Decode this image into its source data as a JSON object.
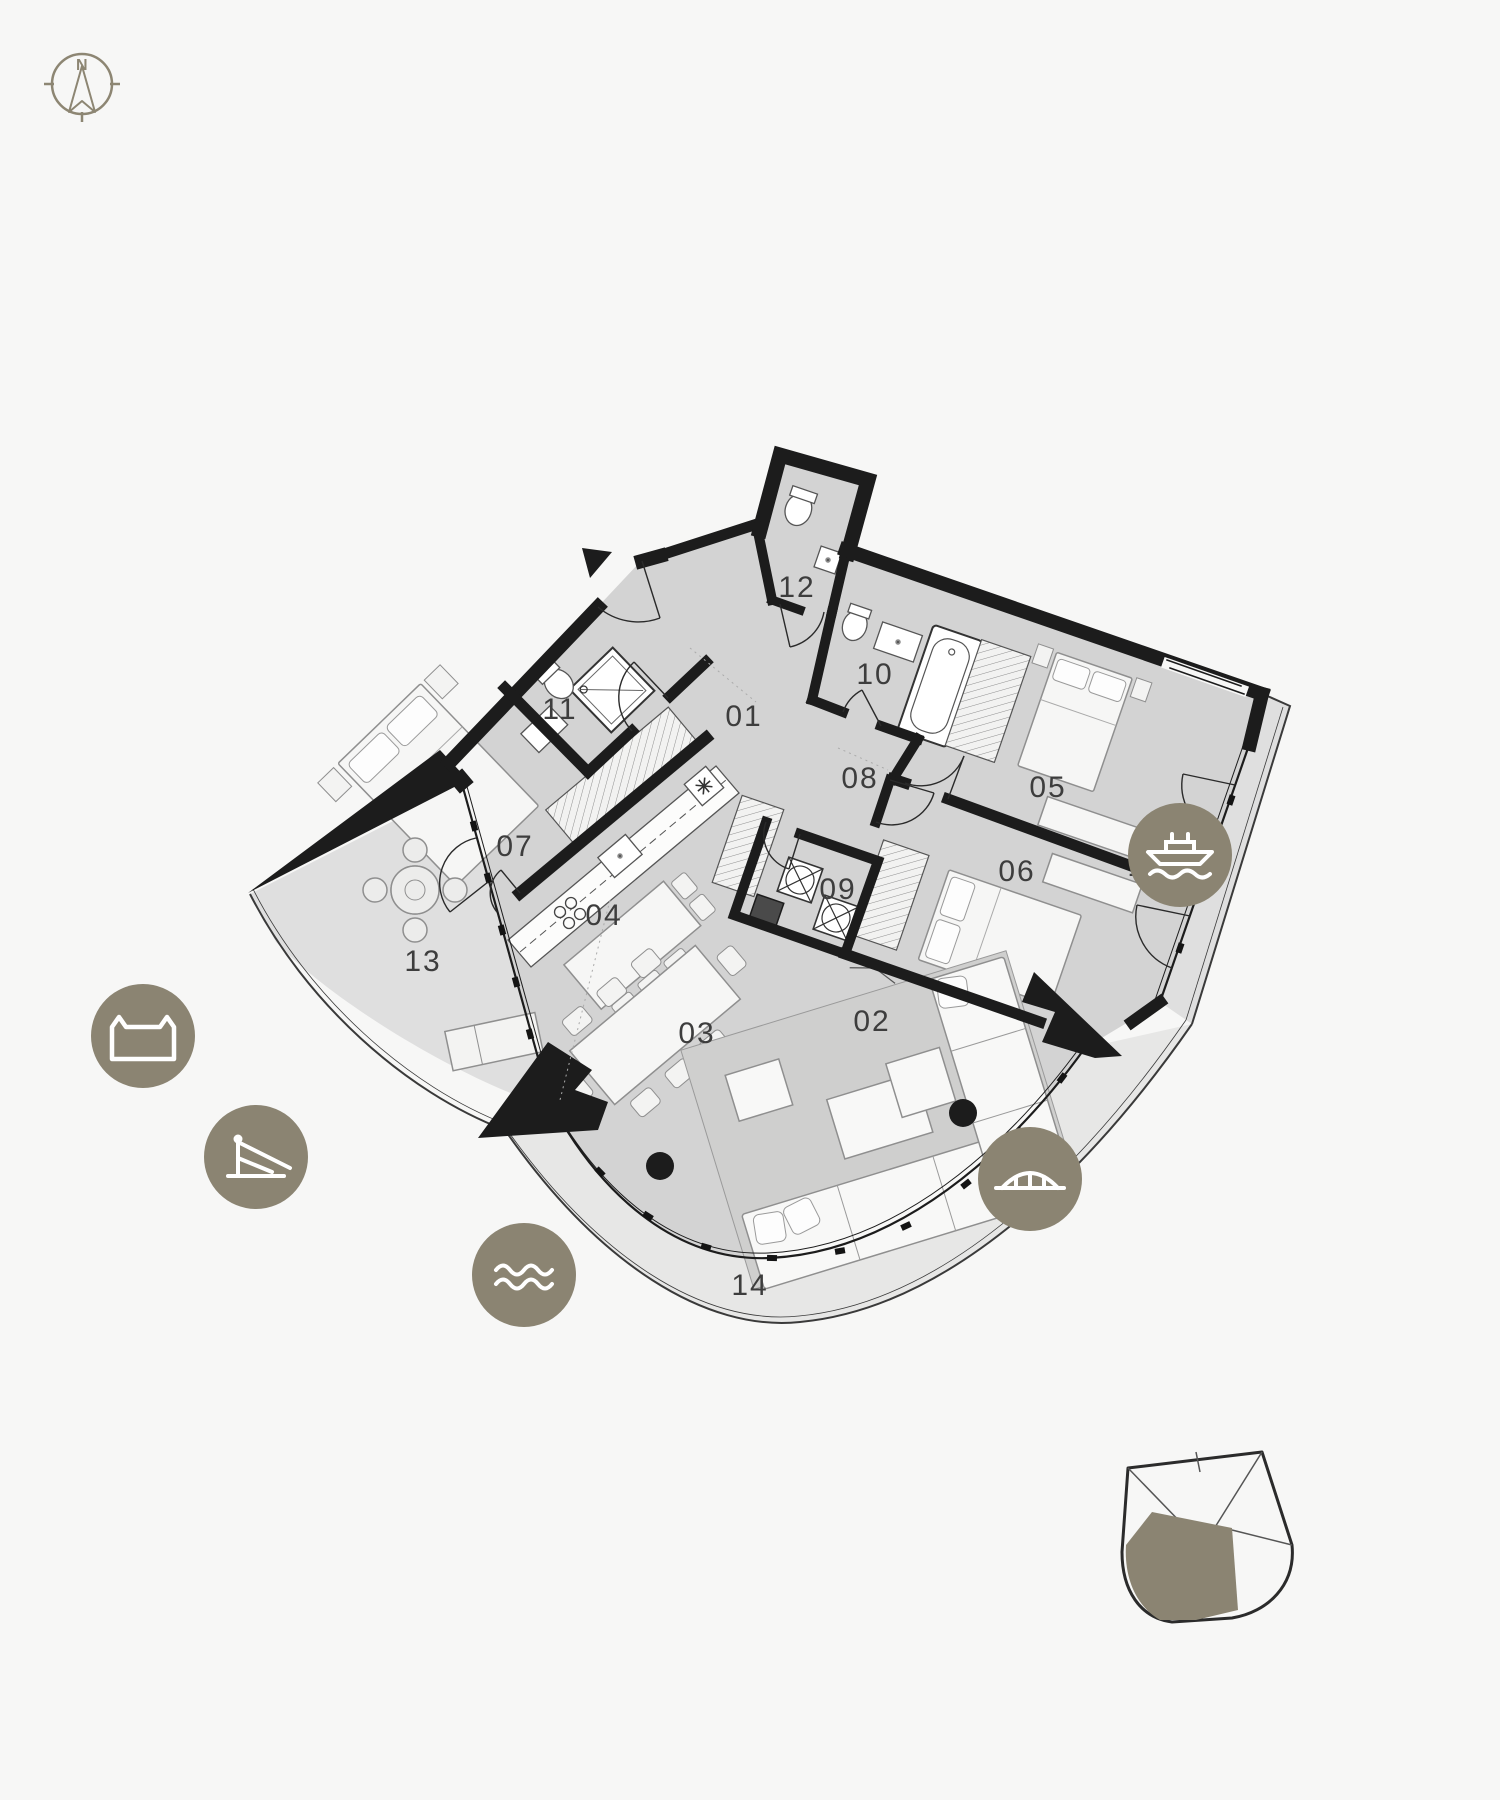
{
  "page": {
    "background": "#f7f7f6",
    "accent_olive": "#8b8472",
    "wall_color": "#1c1c1c",
    "floor_color": "#d3d3d3",
    "balcony_color": "#dfdfdf"
  },
  "compass": {
    "north_label": "N"
  },
  "plan": {
    "rooms": [
      {
        "number": "01"
      },
      {
        "number": "02"
      },
      {
        "number": "03"
      },
      {
        "number": "04"
      },
      {
        "number": "05"
      },
      {
        "number": "06"
      },
      {
        "number": "07"
      },
      {
        "number": "08"
      },
      {
        "number": "09"
      },
      {
        "number": "10"
      },
      {
        "number": "11"
      },
      {
        "number": "12"
      },
      {
        "number": "13"
      },
      {
        "number": "14"
      },
      {
        "number": "15"
      }
    ]
  },
  "badges": [
    {
      "icon": "castle-icon"
    },
    {
      "icon": "ferry-boat-icon"
    },
    {
      "icon": "crane-icon"
    },
    {
      "icon": "waves-icon"
    },
    {
      "icon": "bridge-icon"
    }
  ],
  "keyplan": {
    "description": "building-footprint-key-plan-with-unit-highlight"
  }
}
